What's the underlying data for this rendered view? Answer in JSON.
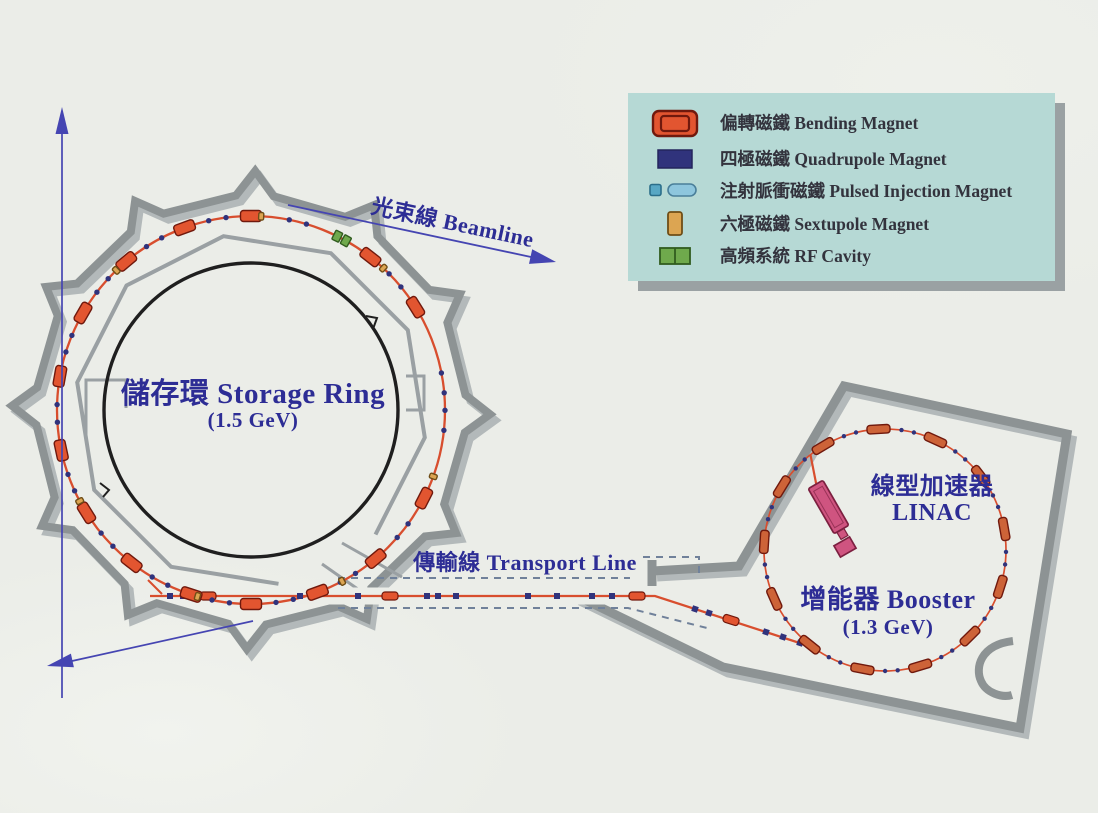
{
  "labels": {
    "storage_ring": "儲存環 Storage Ring",
    "storage_ring_energy": "(1.5 GeV)",
    "booster": "增能器 Booster",
    "booster_energy": "(1.3 GeV)",
    "linac_zh": "線型加速器",
    "linac_en": "LINAC",
    "transport_line": "傳輸線 Transport Line",
    "beamline": "光束線 Beamline"
  },
  "legend": {
    "items": [
      {
        "icon": "bending-magnet-icon",
        "label": "偏轉磁鐵 Bending Magnet"
      },
      {
        "icon": "quadrupole-magnet-icon",
        "label": "四極磁鐵 Quadrupole Magnet"
      },
      {
        "icon": "pulsed-injection-magnet-icon",
        "label": "注射脈衝磁鐵 Pulsed Injection Magnet"
      },
      {
        "icon": "sextupole-magnet-icon",
        "label": "六極磁鐵 Sextupole Magnet"
      },
      {
        "icon": "rf-cavity-icon",
        "label": "高頻系統 RF Cavity"
      }
    ]
  },
  "colors": {
    "page_bg": "#ebede8",
    "legend_bg": "#b6d9d5",
    "legend_shadow": "#9aa1a3",
    "legend_text": "#33333d",
    "label_text": "#2d2d95",
    "wall": "#8d9394",
    "wall_shadow": "#b3b9ba",
    "inner_wall": "#9aa0a3",
    "black_circle": "#1f1f1f",
    "ring_red": "#d84e2e",
    "bending": "#e25530",
    "bending_outline": "#70190d",
    "quadrupole": "#30337c",
    "pulsed_small": "#58a7c4",
    "pulsed_large": "#8ec6dd",
    "sextupole": "#dca552",
    "sextupole_outline": "#6f4d16",
    "rf": "#6fa94c",
    "rf_outline": "#315c1f",
    "booster_bend": "#cd6338",
    "linac": "#cf5480",
    "linac_outline": "#7c2040",
    "arrow": "#4545b2",
    "dash": "#70819a"
  }
}
